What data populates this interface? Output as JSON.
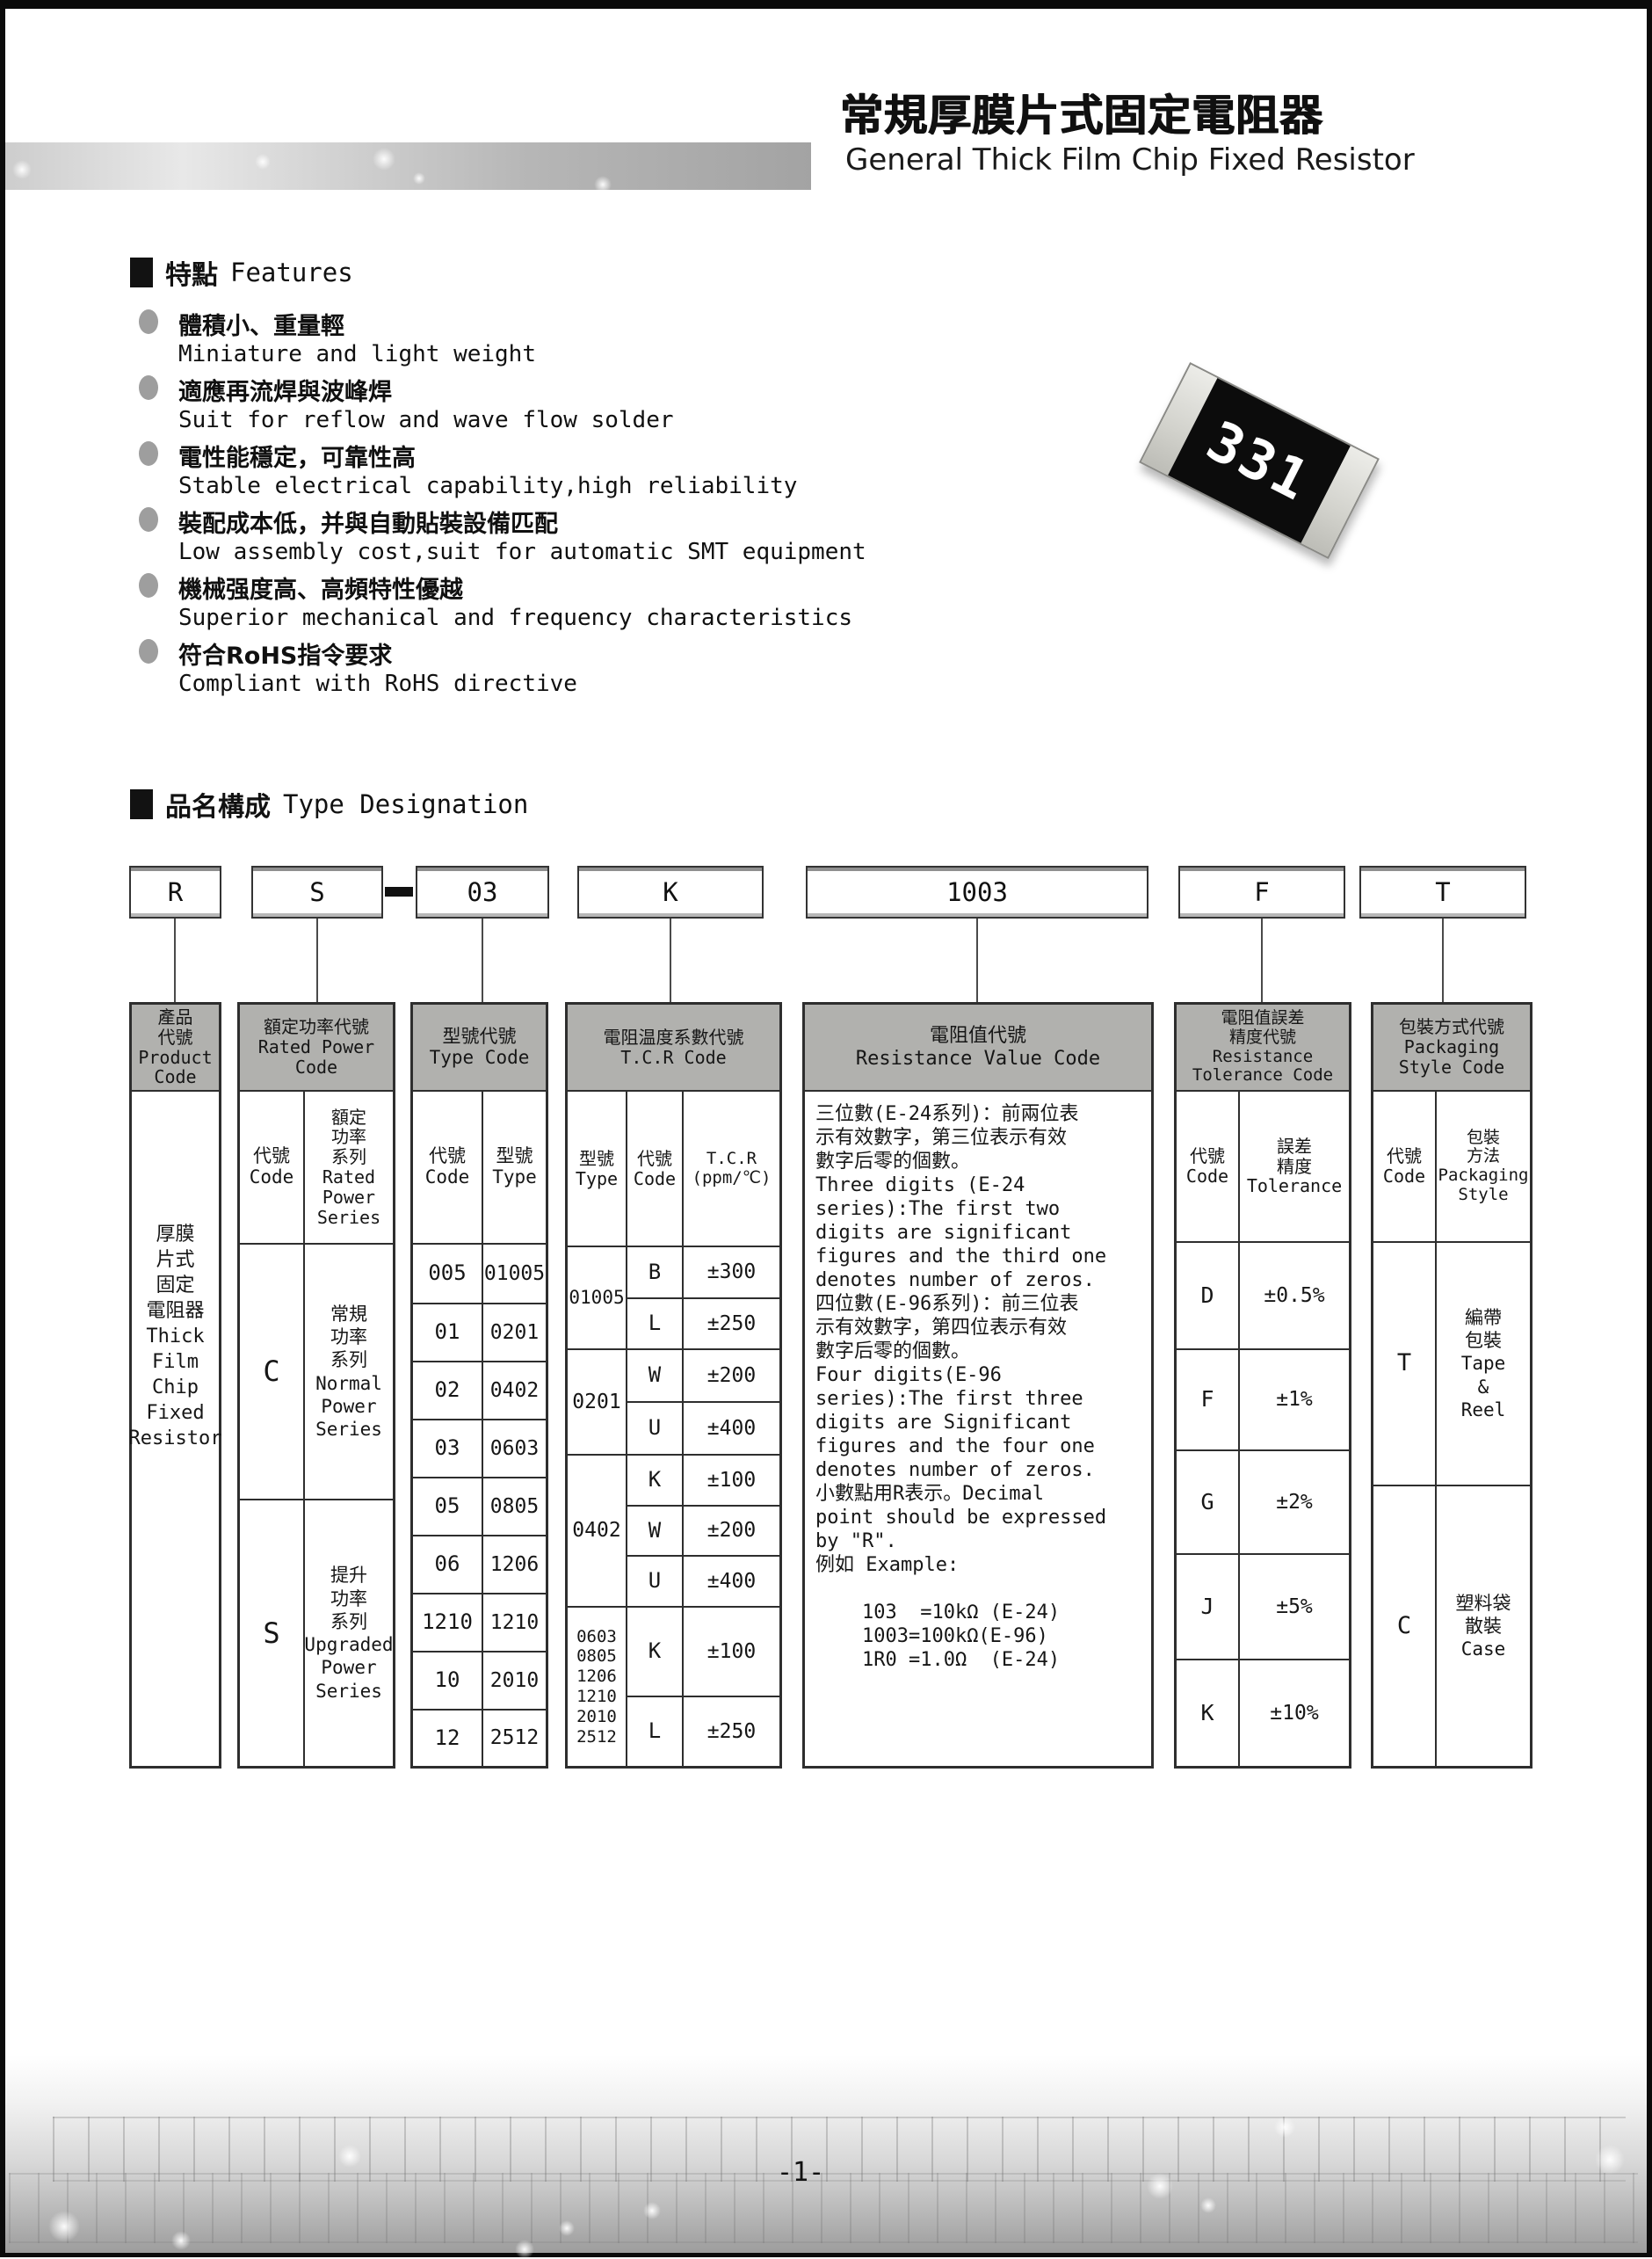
{
  "colors": {
    "header_gray": "#b1b1ae",
    "table_border": "#2e2e2e",
    "chip_body": "#0c0c0c"
  },
  "page": {
    "title_zh": "常規厚膜片式固定電阻器",
    "title_en": "General Thick Film Chip Fixed Resistor",
    "footer_page_number": "-1-"
  },
  "features": {
    "heading_zh": "特點",
    "heading_en": "Features",
    "items": [
      {
        "zh": "體積小、重量輕",
        "en": "Miniature and light weight"
      },
      {
        "zh": "適應再流焊與波峰焊",
        "en": "Suit for reflow and wave flow solder"
      },
      {
        "zh": "電性能穩定，可靠性高",
        "en": "Stable electrical capability,high reliability"
      },
      {
        "zh": "裝配成本低，并與自動貼裝設備匹配",
        "en": "Low assembly cost,suit for automatic SMT equipment"
      },
      {
        "zh": "機械强度高、高頻特性優越",
        "en": "Superior mechanical and frequency characteristics"
      },
      {
        "zh": "符合RoHS指令要求",
        "en": "Compliant with RoHS directive"
      }
    ]
  },
  "chip": {
    "marking": "331"
  },
  "type_designation": {
    "heading_zh": "品名構成",
    "heading_en": "Type Designation",
    "code_boxes": {
      "product": "R",
      "power": "S",
      "dash": "",
      "type": "03",
      "tcr": "K",
      "value": "1003",
      "tolerance": "F",
      "packaging": "T"
    },
    "product_col": {
      "header": "產品\n代號\nProduct\nCode",
      "body": "厚膜\n片式\n固定\n電阻器\nThick\nFilm\nChip\nFixed\nResistor"
    },
    "power_col": {
      "header": "額定功率代號\nRated Power\nCode",
      "sub_code": "代號\nCode",
      "sub_series": "額定\n功率\n系列\nRated\nPower\nSeries",
      "rows": [
        {
          "code": "C",
          "series": "常規\n功率\n系列\nNormal\nPower\nSeries"
        },
        {
          "code": "S",
          "series": "提升\n功率\n系列\nUpgraded\nPower\nSeries"
        }
      ]
    },
    "type_col": {
      "header": "型號代號\nType Code",
      "sub_code": "代號\nCode",
      "sub_type": "型號\nType",
      "rows": [
        {
          "code": "005",
          "type": "01005"
        },
        {
          "code": "01",
          "type": "0201"
        },
        {
          "code": "02",
          "type": "0402"
        },
        {
          "code": "03",
          "type": "0603"
        },
        {
          "code": "05",
          "type": "0805"
        },
        {
          "code": "06",
          "type": "1206"
        },
        {
          "code": "1210",
          "type": "1210"
        },
        {
          "code": "10",
          "type": "2010"
        },
        {
          "code": "12",
          "type": "2512"
        }
      ]
    },
    "tcr_col": {
      "header": "電阻温度系數代號\nT.C.R Code",
      "sub_type": "型號\nType",
      "sub_code": "代號\nCode",
      "sub_tcr": "T.C.R\n(ppm/℃)",
      "groups": [
        {
          "type": "01005",
          "rows": [
            {
              "code": "B",
              "tcr": "±300"
            },
            {
              "code": "L",
              "tcr": "±250"
            }
          ]
        },
        {
          "type": "0201",
          "rows": [
            {
              "code": "W",
              "tcr": "±200"
            },
            {
              "code": "U",
              "tcr": "±400"
            }
          ]
        },
        {
          "type": "0402",
          "rows": [
            {
              "code": "K",
              "tcr": "±100"
            },
            {
              "code": "W",
              "tcr": "±200"
            },
            {
              "code": "U",
              "tcr": "±400"
            }
          ]
        },
        {
          "type": "0603\n0805\n1206\n1210\n2010\n2512",
          "rows": [
            {
              "code": "K",
              "tcr": "±100"
            },
            {
              "code": "L",
              "tcr": "±250"
            }
          ]
        }
      ]
    },
    "value_col": {
      "header": "電阻值代號\nResistance Value Code",
      "body": "三位數(E-24系列)：前兩位表\n示有效數字，第三位表示有效\n數字后零的個數。\nThree digits (E-24\nseries):The first two\ndigits are significant\nfigures and the third one\ndenotes number of zeros.\n四位數(E-96系列)：前三位表\n示有效數字，第四位表示有效\n數字后零的個數。\nFour digits(E-96\nseries):The first three\ndigits are Significant\nfigures and the four one\ndenotes number of zeros.\n小數點用R表示。Decimal\npoint should be expressed\nby \"R\".\n例如 Example:\n\n    103  =10kΩ (E-24)\n    1003=100kΩ(E-96)\n    1R0 =1.0Ω  (E-24)"
    },
    "tolerance_col": {
      "header": "電阻值誤差\n精度代號\nResistance\nTolerance Code",
      "sub_code": "代號\nCode",
      "sub_tol": "誤差\n精度\nTolerance",
      "rows": [
        {
          "code": "D",
          "tol": "±0.5%"
        },
        {
          "code": "F",
          "tol": "±1%"
        },
        {
          "code": "G",
          "tol": "±2%"
        },
        {
          "code": "J",
          "tol": "±5%"
        },
        {
          "code": "K",
          "tol": "±10%"
        }
      ]
    },
    "packaging_col": {
      "header": "包裝方式代號\nPackaging\nStyle Code",
      "sub_code": "代號\nCode",
      "sub_style": "包裝\n方法\nPackaging\nStyle",
      "rows": [
        {
          "code": "T",
          "style": "編帶\n包裝\nTape\n&\nReel"
        },
        {
          "code": "C",
          "style": "塑料袋\n散裝\nCase"
        }
      ]
    }
  }
}
